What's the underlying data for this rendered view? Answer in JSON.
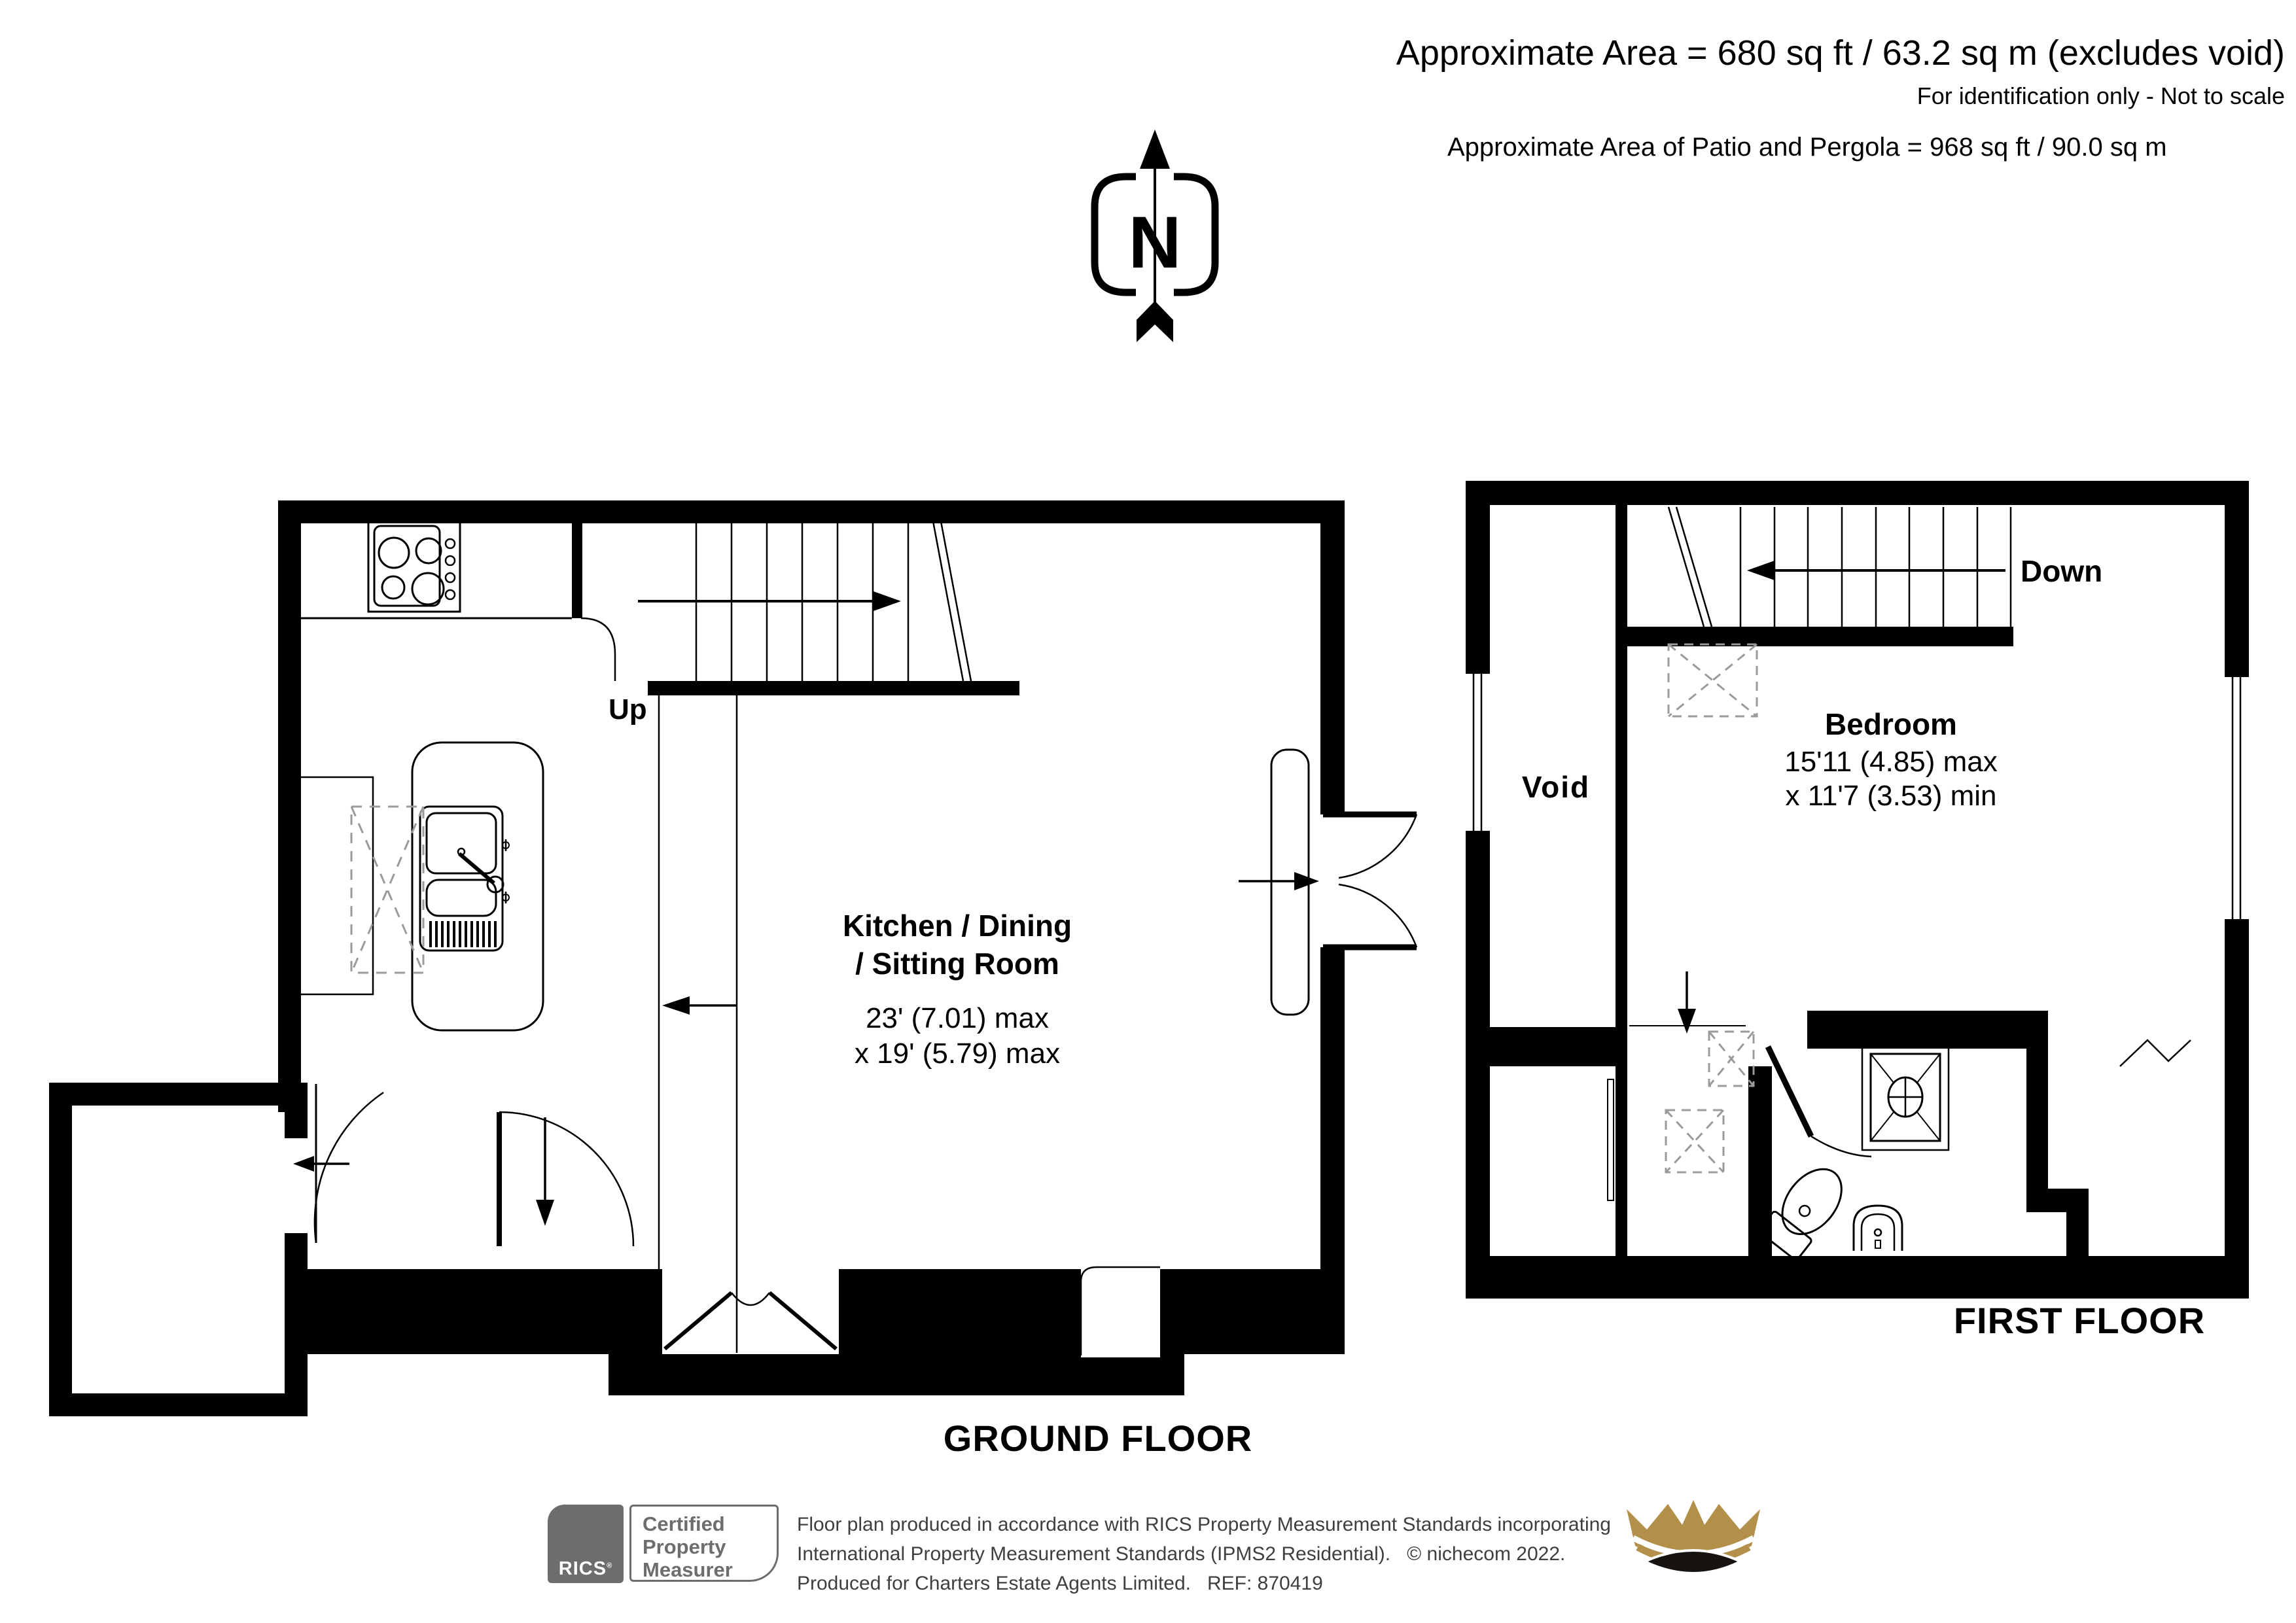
{
  "header": {
    "area_line": "Approximate Area = 680 sq ft / 63.2 sq m (excludes void)",
    "note_line": "For identification only - Not to scale",
    "patio_line": "Approximate Area of Patio and Pergola = 968 sq ft / 90.0 sq m"
  },
  "compass": {
    "north_label": "N"
  },
  "ground_floor": {
    "title": "GROUND FLOOR",
    "stairs_label": "Up",
    "room": {
      "name_line1": "Kitchen / Dining",
      "name_line2": "/ Sitting Room",
      "dim_line1": "23' (7.01) max",
      "dim_line2": "x 19' (5.79) max"
    }
  },
  "first_floor": {
    "title": "FIRST FLOOR",
    "stairs_label": "Down",
    "void_label": "Void",
    "room": {
      "name": "Bedroom",
      "dim_line1": "15'11 (4.85) max",
      "dim_line2": "x 11'7 (3.53) min"
    }
  },
  "footer": {
    "rics_label": "RICS",
    "rics_reg_mark": "®",
    "cert_line1": "Certified",
    "cert_line2": "Property",
    "cert_line3": "Measurer",
    "disclaimer_line1": "Floor plan produced in accordance with RICS Property Measurement Standards incorporating",
    "disclaimer_line2": "International Property Measurement Standards (IPMS2 Residential).   © nichecom 2022.",
    "disclaimer_line3": "Produced for Charters Estate Agents Limited.   REF: 870419"
  },
  "colors": {
    "wall": "#000000",
    "dashed_gray": "#9a9a9a",
    "footer_gray": "#6d6d6d",
    "crown_gold": "#b2904a"
  }
}
